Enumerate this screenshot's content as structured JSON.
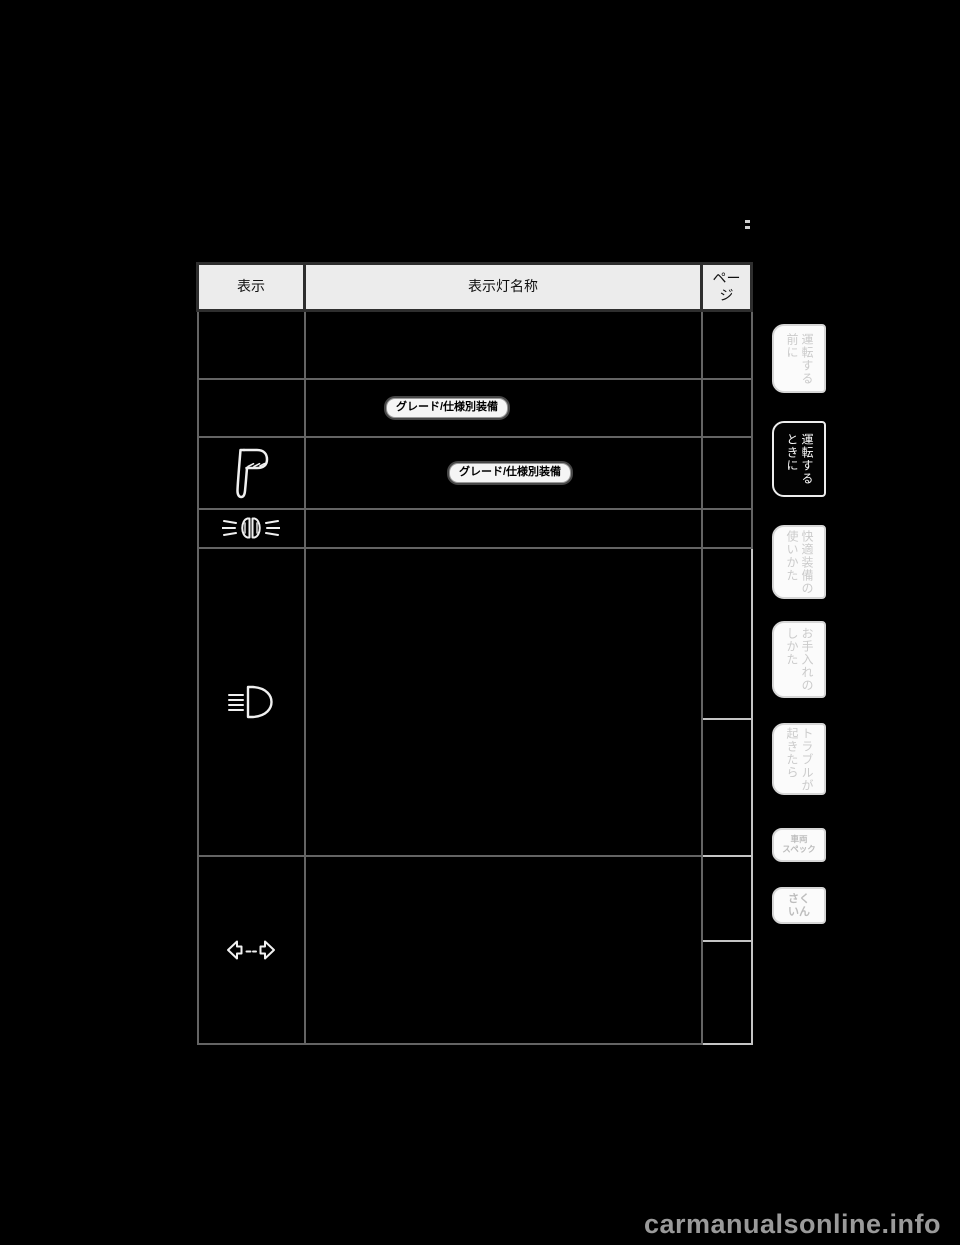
{
  "page": {
    "watermark": "carmanualsonline.info"
  },
  "colors": {
    "page_bg": "#000000",
    "table_header_bg": "#ececec",
    "table_grid": "#646464",
    "badge_bg": "#f5f5f5",
    "badge_text": "#000000",
    "tab_active_bg": "#000000",
    "tab_active_text": "#ffffff",
    "tab_inactive_bg": "#fbfbfb",
    "tab_inactive_text": "#cbcbcb"
  },
  "table": {
    "headers": {
      "display": "表示",
      "name": "表示灯名称",
      "page": "ペー\nジ"
    },
    "badge_label": "グレード/仕様別装備",
    "rows": [
      {
        "display_icon": "",
        "has_badge": false
      },
      {
        "display_icon": "",
        "has_badge": true
      },
      {
        "display_icon": "parking-lamp-icon",
        "has_badge": true
      },
      {
        "display_icon": "tail-lamp-icon",
        "has_badge": false
      },
      {
        "display_icon": "headlight-icon",
        "has_badge": false
      },
      {
        "display_icon": "turn-signal-icon",
        "has_badge": false
      }
    ]
  },
  "sidebar": {
    "tabs": [
      {
        "label": "運転する\n前に",
        "active": false
      },
      {
        "label": "運転する\nときに",
        "active": true
      },
      {
        "label": "快適装備の\n使いかた",
        "active": false
      },
      {
        "label": "お手入れの\nしかた",
        "active": false
      },
      {
        "label": "トラブルが\n起きたら",
        "active": false
      },
      {
        "label": "車両\nスペック",
        "active": false
      },
      {
        "label": "さく\nいん",
        "active": false
      }
    ]
  }
}
